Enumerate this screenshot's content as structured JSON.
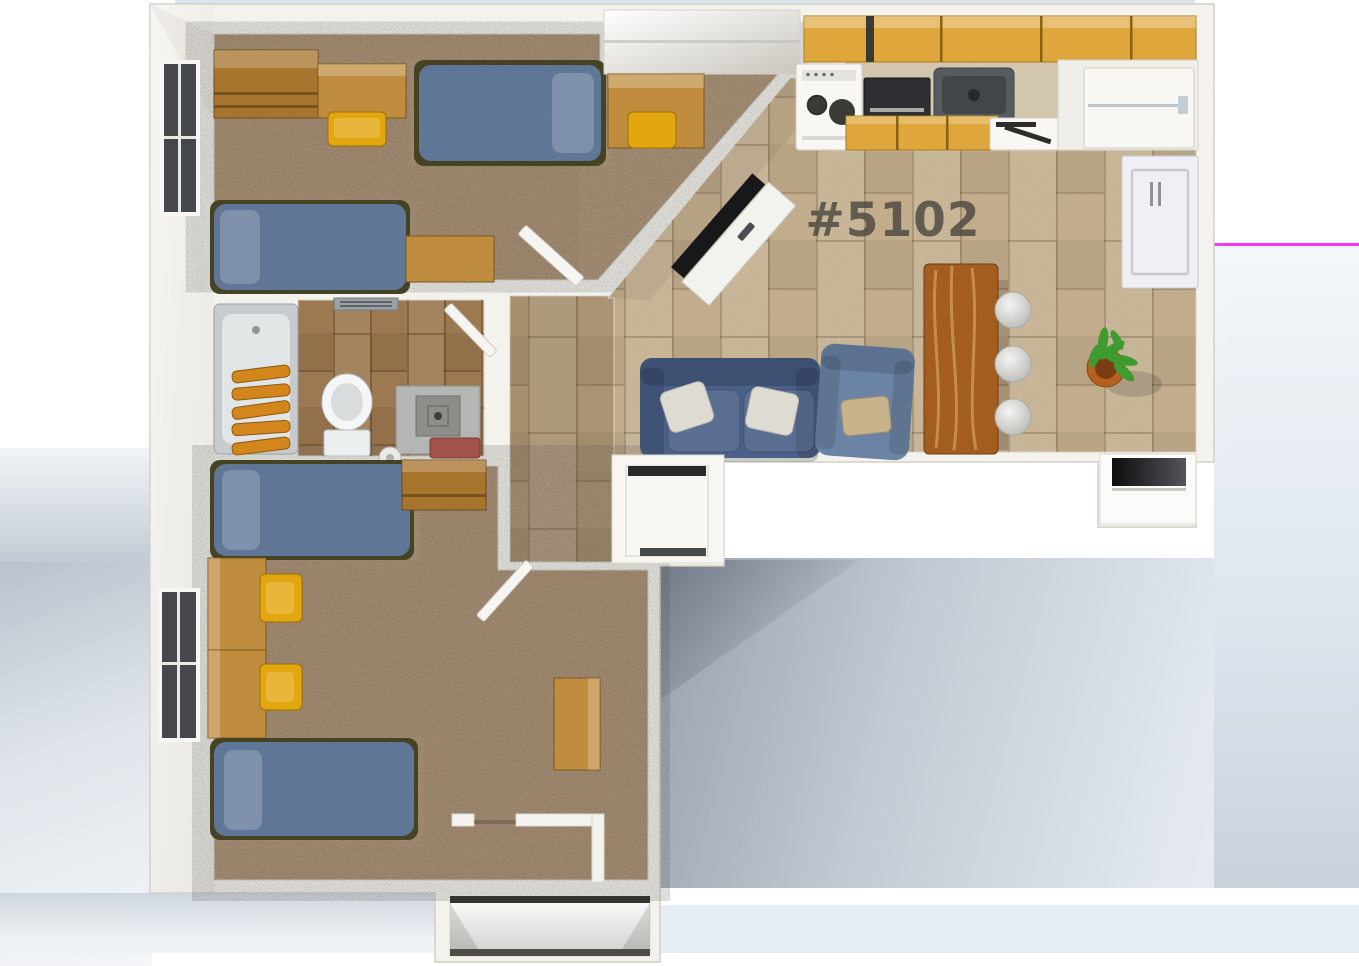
{
  "unit_label": "#5102",
  "colors": {
    "wall": "#f3f2ed",
    "wall_shade": "#ddd9d0",
    "outline": "#d2cec5",
    "carpet": "#a98e71",
    "tile_living": "#c0aa89",
    "tile_bath": "#9c7950",
    "tile_hall": "#b49a78",
    "mattress_blue": "#5a7193",
    "pillow_blue": "#8495ae",
    "bed_frame_olive": "#3f3c1c",
    "wood": "#a8752f",
    "wood_light": "#c08d3f",
    "chair_yellow": "#e2a60f",
    "sofa_blue": "#4a6088",
    "armchair_blue": "#6b84a6",
    "pillow_white": "#dedcd2",
    "pillow_tan": "#c8b28b",
    "cabinet_gold": "#dfa73b",
    "counter_marble": "#cfc2a8",
    "appliance_white": "#f8f7f4",
    "appliance_dark": "#2d2f32",
    "sink_gray": "#565b60",
    "towel_orange": "#d2861c",
    "towel_red": "#a3524b",
    "table_wood": "#a35d1e",
    "stool_gray": "#d9d9d5",
    "pot_terracotta": "#b5601f",
    "plant_green": "#3f9b2f",
    "window_dark": "#44474b",
    "tv_black": "#17181a",
    "label_color": "#4c4740",
    "top_edge_blue": "#cfdde9",
    "backdrop_pink": "#f438f4"
  },
  "rooms": [
    {
      "name": "Bedroom (top)",
      "furniture": [
        "wardrobe",
        "desk",
        "desk-chair",
        "bed",
        "bed",
        "desk",
        "built-in-closet",
        "window"
      ]
    },
    {
      "name": "Bathroom",
      "furniture": [
        "bathtub",
        "towel-rack",
        "toilet",
        "vanity-sink",
        "toilet-paper",
        "vent"
      ]
    },
    {
      "name": "Kitchen",
      "furniture": [
        "stove",
        "microwave",
        "sink",
        "dishwasher",
        "refrigerator",
        "upper-cabinets",
        "lower-cabinets"
      ]
    },
    {
      "name": "Living-dining",
      "furniture": [
        "tv-stand",
        "tv",
        "loveseat",
        "armchair",
        "dining-table",
        "stool",
        "stool",
        "stool",
        "potted-plant",
        "wall-door",
        "storage-nook"
      ]
    },
    {
      "name": "Bedroom (bottom)",
      "furniture": [
        "bed",
        "bed",
        "desk",
        "desk",
        "desk",
        "desk-chair",
        "desk-chair",
        "dresser",
        "closet",
        "window"
      ]
    },
    {
      "name": "Hallway",
      "furniture": [
        "door",
        "door",
        "door"
      ]
    },
    {
      "name": "Utility-closet",
      "furniture": [
        "water-heater"
      ]
    },
    {
      "name": "Entry",
      "furniture": [
        "entry-alcove"
      ]
    }
  ]
}
